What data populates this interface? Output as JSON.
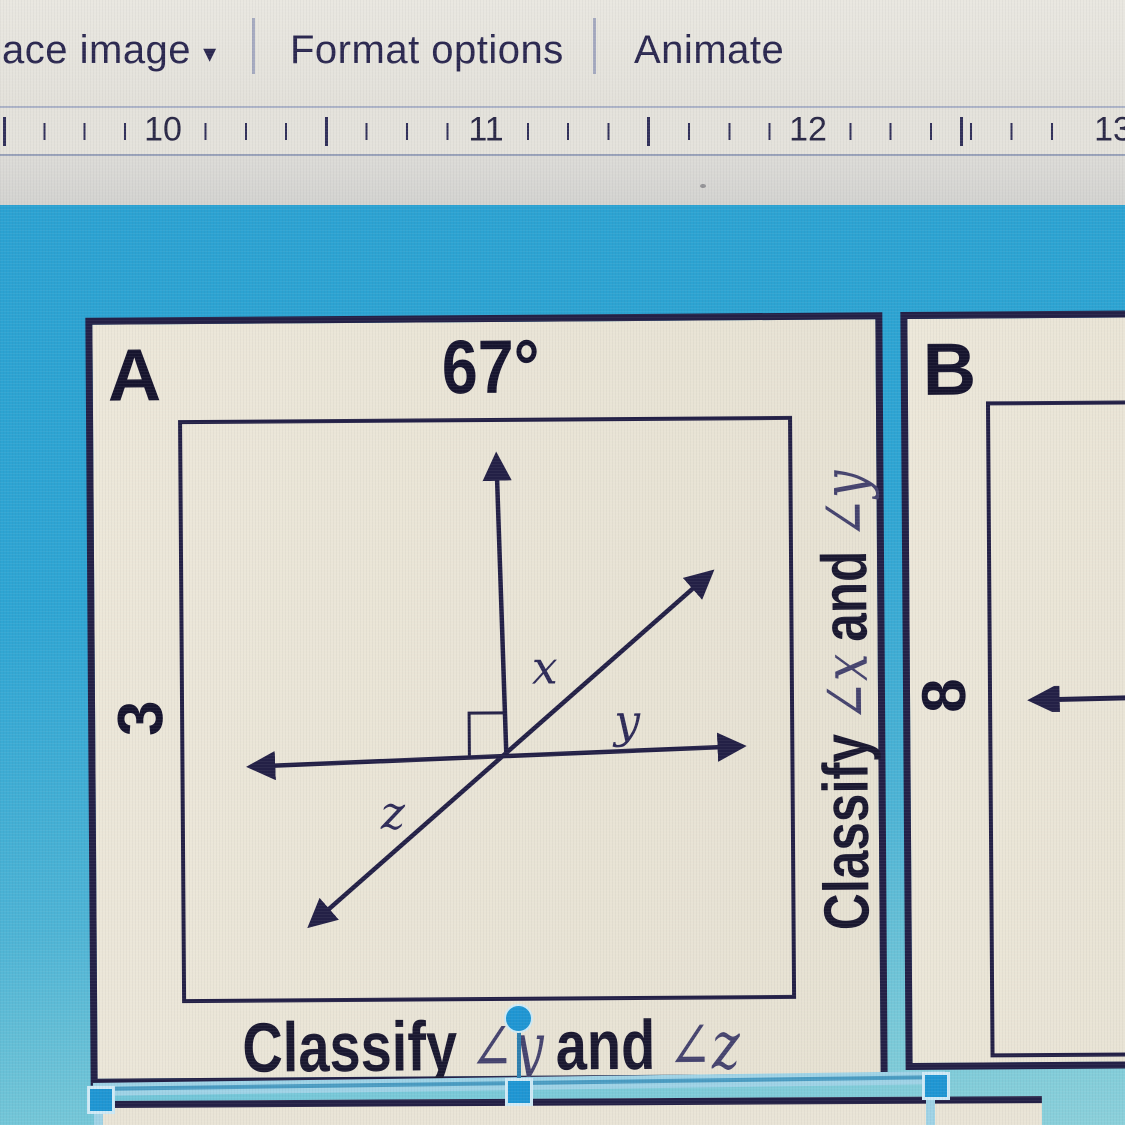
{
  "toolbar": {
    "replace_image_label": "ace image",
    "dropdown_icon": "▾",
    "format_options_label": "Format options",
    "animate_label": "Animate"
  },
  "ruler": {
    "numbers": [
      "10",
      "11",
      "12",
      "13"
    ]
  },
  "slide": {
    "card_a": {
      "label": "A",
      "problem_number": "3",
      "angle_value": "67°",
      "diagram_labels": {
        "x": "x",
        "y": "y",
        "z": "z"
      },
      "side_caption": {
        "classify": "Classify",
        "angle_1": "∠x",
        "and": "and",
        "angle_2": "∠y"
      },
      "bottom_caption": {
        "classify": "Classify",
        "angle_1": "∠y",
        "and": "and",
        "angle_2": "∠z"
      }
    },
    "card_b": {
      "label": "B",
      "problem_number": "8"
    }
  },
  "colors": {
    "canvas_blue": "#2ea5d3",
    "card_beige": "#e9e4d6",
    "ink_navy": "#232046",
    "selection_blue": "#1f96d3",
    "selection_band": "#9fd3e6",
    "toolbar_text": "#2b2850"
  }
}
